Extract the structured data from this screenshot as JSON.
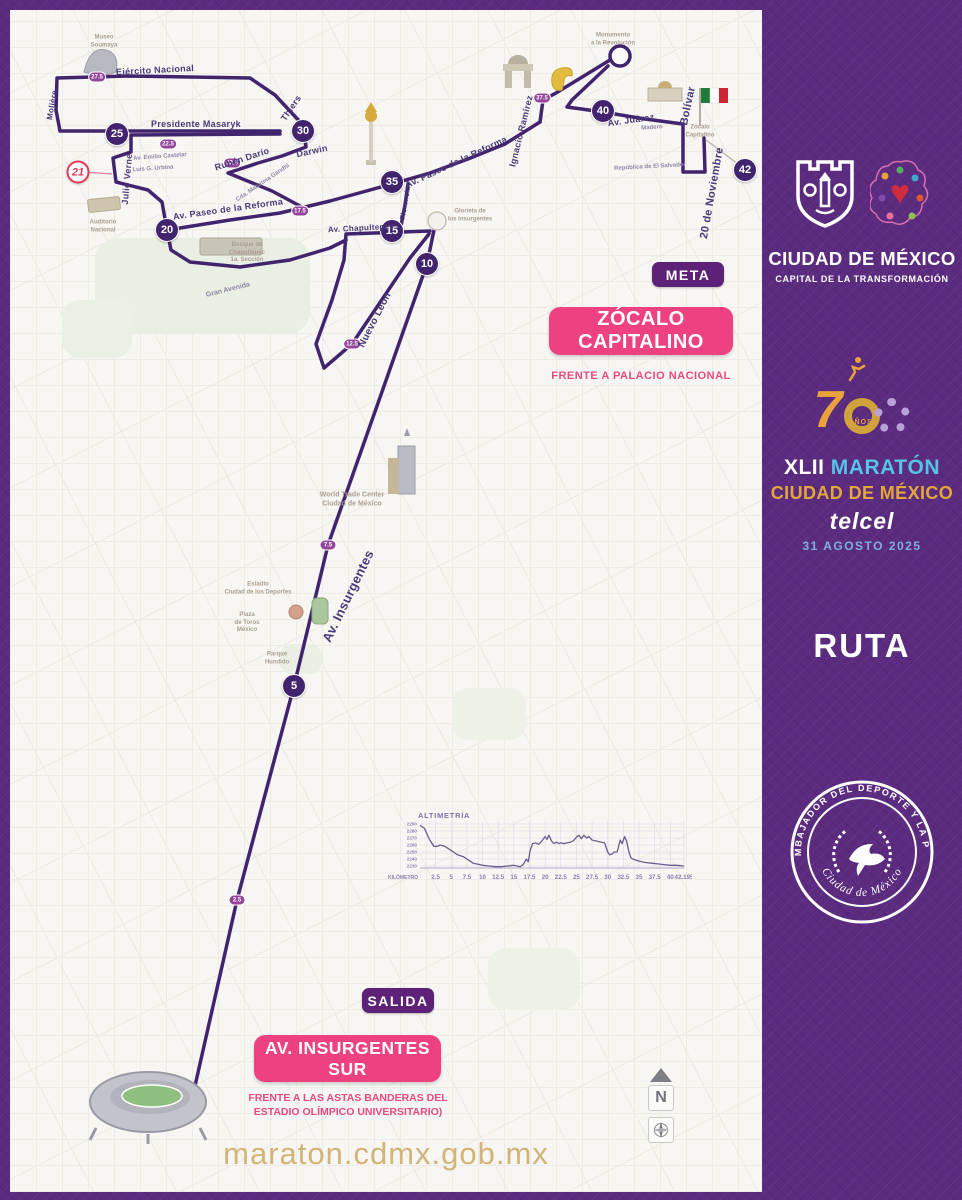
{
  "colors": {
    "purple_bg": "#5b2b7f",
    "route": "#41246d",
    "pink": "#ee4181",
    "gold_url": "#d2b478",
    "marker": "#41246d",
    "half_red": "#e63a56",
    "mini": "#94449a"
  },
  "sidebar": {
    "city_logo": {
      "title": "CIUDAD DE MÉXICO",
      "subtitle": "CAPITAL DE LA TRANSFORMACIÓN"
    },
    "anniversary": {
      "seven": "7",
      "years_label": "AÑOS"
    },
    "event": {
      "numeral": "XLII",
      "name": "MARATÓN",
      "city": "CIUDAD DE MÉXICO",
      "sponsor": "telcel",
      "date": "31 AGOSTO 2025"
    },
    "route_label": "RUTA",
    "badge": {
      "top_text": "EMBAJADOR DEL DEPORTE Y LA PAZ",
      "bottom_text": "Ciudad de México"
    }
  },
  "map": {
    "meta_label": "META",
    "finish_banner": "ZÓCALO CAPITALINO",
    "finish_sub": "FRENTE A PALACIO NACIONAL",
    "salida_label": "SALIDA",
    "start_banner": "AV. INSURGENTES SUR",
    "start_sub": "FRENTE A LAS ASTAS BANDERAS DEL\nESTADIO OLÍMPICO UNIVERSITARIO)",
    "url": "maraton.cdmx.gob.mx",
    "compass_letter": "N",
    "km_markers": [
      {
        "t": "5",
        "x": 294,
        "y": 686
      },
      {
        "t": "10",
        "x": 427,
        "y": 264
      },
      {
        "t": "15",
        "x": 392,
        "y": 231
      },
      {
        "t": "20",
        "x": 167,
        "y": 230
      },
      {
        "t": "25",
        "x": 117,
        "y": 134
      },
      {
        "t": "30",
        "x": 303,
        "y": 131
      },
      {
        "t": "35",
        "x": 392,
        "y": 182
      },
      {
        "t": "40",
        "x": 603,
        "y": 111
      },
      {
        "t": "42",
        "x": 745,
        "y": 170
      }
    ],
    "half_marker": {
      "t": "21",
      "x": 78,
      "y": 172
    },
    "minor_markers": [
      {
        "t": "2.5",
        "x": 237,
        "y": 900
      },
      {
        "t": "7.5",
        "x": 328,
        "y": 545
      },
      {
        "t": "12.5",
        "x": 352,
        "y": 344
      },
      {
        "t": "17.5",
        "x": 300,
        "y": 211
      },
      {
        "t": "22.5",
        "x": 168,
        "y": 144
      },
      {
        "t": "27.5",
        "x": 97,
        "y": 77
      },
      {
        "t": "32.5",
        "x": 232,
        "y": 163
      },
      {
        "t": "37.5",
        "x": 542,
        "y": 98
      }
    ],
    "streets": [
      {
        "t": "Ejército Nacional",
        "x": 155,
        "y": 70,
        "r": -3,
        "s": 9
      },
      {
        "t": "Molière",
        "x": 52,
        "y": 105,
        "r": -80,
        "s": 8
      },
      {
        "t": "Presidente Masaryk",
        "x": 196,
        "y": 124,
        "r": 0,
        "s": 9
      },
      {
        "t": "Thiers",
        "x": 291,
        "y": 108,
        "r": -56,
        "s": 9
      },
      {
        "t": "Darwin",
        "x": 312,
        "y": 151,
        "r": -12,
        "s": 9
      },
      {
        "t": "Rubén Darío",
        "x": 242,
        "y": 159,
        "r": -18,
        "s": 9
      },
      {
        "t": "Julio Verne",
        "x": 127,
        "y": 179,
        "r": -85,
        "s": 9
      },
      {
        "t": "Av. Paseo de la Reforma",
        "x": 228,
        "y": 209,
        "r": -8,
        "s": 9
      },
      {
        "t": "Av. Paseo de la Reforma",
        "x": 456,
        "y": 162,
        "r": -25,
        "s": 9
      },
      {
        "t": "Av. Chapultepec",
        "x": 361,
        "y": 228,
        "r": -3,
        "s": 8
      },
      {
        "t": "Florencia",
        "x": 406,
        "y": 203,
        "r": -80,
        "s": 7
      },
      {
        "t": "Nuevo León",
        "x": 375,
        "y": 320,
        "r": -63,
        "s": 10
      },
      {
        "t": "Av. Insurgentes",
        "x": 348,
        "y": 596,
        "r": -64,
        "s": 13
      },
      {
        "t": "Ignacio Ramírez",
        "x": 521,
        "y": 131,
        "r": -76,
        "s": 9
      },
      {
        "t": "Av. Juárez",
        "x": 631,
        "y": 120,
        "r": -8,
        "s": 9
      },
      {
        "t": "Bolívar",
        "x": 688,
        "y": 106,
        "r": -78,
        "s": 11
      },
      {
        "t": "20 de Noviembre",
        "x": 712,
        "y": 193,
        "r": -80,
        "s": 11
      }
    ],
    "streets_tiny": [
      {
        "t": "Av. Emilio Castelar",
        "x": 160,
        "y": 157,
        "r": -4,
        "s": 6
      },
      {
        "t": "Luis G. Urbina",
        "x": 153,
        "y": 169,
        "r": -4,
        "s": 6
      },
      {
        "t": "Cda. Mahatma Gandhi",
        "x": 263,
        "y": 183,
        "r": -34,
        "s": 6
      },
      {
        "t": "Gran Avenida",
        "x": 228,
        "y": 290,
        "r": -14,
        "s": 7
      },
      {
        "t": "Madero",
        "x": 652,
        "y": 128,
        "r": -4,
        "s": 6
      },
      {
        "t": "República de El Salvador",
        "x": 650,
        "y": 167,
        "r": -3,
        "s": 6
      }
    ],
    "pois": [
      {
        "t": "Museo\nSoumaya",
        "x": 104,
        "y": 42,
        "s": 6
      },
      {
        "t": "Auditorio\nNacional",
        "x": 103,
        "y": 227,
        "s": 6
      },
      {
        "t": "Bosque de\nChapultepec\n1a. Sección",
        "x": 247,
        "y": 253,
        "s": 6
      },
      {
        "t": "Glorieta de\nlos Insurgentes",
        "x": 470,
        "y": 216,
        "s": 6
      },
      {
        "t": "Monumento\na la Revolución",
        "x": 613,
        "y": 40,
        "s": 6
      },
      {
        "t": "Zócalo\nCapitalino",
        "x": 700,
        "y": 132,
        "s": 6
      },
      {
        "t": "World Trade Center\nCiudad de México",
        "x": 352,
        "y": 500,
        "s": 7
      },
      {
        "t": "Estadio\nCiudad de los Deportes",
        "x": 258,
        "y": 589,
        "s": 6
      },
      {
        "t": "Plaza\nde Toros\nMéxico",
        "x": 247,
        "y": 623,
        "s": 6
      },
      {
        "t": "Parque\nHundido",
        "x": 277,
        "y": 659,
        "s": 6
      }
    ],
    "route": {
      "lines": [
        [
          [
            190,
            1108
          ],
          [
            237,
            900
          ],
          [
            294,
            686
          ],
          [
            328,
            545
          ],
          [
            427,
            264
          ],
          [
            434,
            230
          ]
        ],
        [
          [
            429,
            234
          ],
          [
            410,
            258
          ],
          [
            352,
            344
          ],
          [
            324,
            368
          ],
          [
            316,
            344
          ],
          [
            332,
            300
          ],
          [
            344,
            260
          ],
          [
            346,
            234
          ],
          [
            430,
            231
          ]
        ],
        [
          [
            400,
            231
          ],
          [
            405,
            205
          ],
          [
            408,
            184
          ]
        ],
        [
          [
            167,
            230
          ],
          [
            180,
            228
          ],
          [
            230,
            220
          ],
          [
            280,
            213
          ],
          [
            330,
            201
          ],
          [
            370,
            190
          ],
          [
            392,
            184
          ],
          [
            430,
            173
          ],
          [
            468,
            159
          ],
          [
            505,
            144
          ],
          [
            540,
            122
          ]
        ],
        [
          [
            167,
            230
          ],
          [
            171,
            250
          ],
          [
            190,
            262
          ],
          [
            240,
            267
          ],
          [
            290,
            260
          ],
          [
            330,
            248
          ],
          [
            346,
            240
          ]
        ],
        [
          [
            167,
            230
          ],
          [
            162,
            202
          ],
          [
            148,
            190
          ],
          [
            116,
            182
          ],
          [
            113,
            158
          ],
          [
            131,
            152
          ],
          [
            131,
            135
          ],
          [
            280,
            134
          ]
        ],
        [
          [
            280,
            131
          ],
          [
            95,
            131
          ],
          [
            60,
            131
          ],
          [
            56,
            110
          ],
          [
            57,
            78
          ],
          [
            130,
            76
          ],
          [
            250,
            78
          ],
          [
            275,
            95
          ],
          [
            303,
            125
          ],
          [
            306,
            147
          ],
          [
            282,
            156
          ],
          [
            258,
            163
          ],
          [
            228,
            173
          ],
          [
            250,
            182
          ],
          [
            272,
            191
          ],
          [
            300,
            206
          ]
        ],
        [
          [
            540,
            122
          ],
          [
            543,
            100
          ],
          [
            556,
            93
          ],
          [
            610,
            60
          ]
        ],
        [
          [
            608,
            66
          ],
          [
            572,
            100
          ],
          [
            567,
            107
          ],
          [
            603,
            112
          ],
          [
            645,
            119
          ],
          [
            683,
            124
          ],
          [
            683,
            172
          ],
          [
            705,
            172
          ],
          [
            704,
            138
          ]
        ]
      ],
      "thin_lines": [
        {
          "pts": [
            [
              82,
              172
            ],
            [
              112,
              174
            ]
          ],
          "color": "#ef7c9a",
          "w": 1.2
        },
        {
          "pts": [
            [
              706,
              140
            ],
            [
              738,
              164
            ]
          ],
          "color": "#b9b2a6",
          "w": 1.2
        }
      ],
      "circles": [
        {
          "x": 437,
          "y": 221,
          "r": 9,
          "fill": "#f3f1ec",
          "stroke": "#c6c0b4",
          "w": 1.5
        },
        {
          "x": 620,
          "y": 56,
          "r": 10,
          "fill": "#ffffff",
          "stroke": "#41246d",
          "w": 3.5
        }
      ],
      "start_bar": {
        "x": 174,
        "y": 1102,
        "w": 30,
        "h": 8
      }
    }
  },
  "chart_data": {
    "type": "line",
    "title": "ALTIMETRÍA",
    "xlabel": "KILÓMETRO",
    "ylabel": "",
    "xlim": [
      0,
      42.195
    ],
    "ylim": [
      2220,
      2295
    ],
    "xticks": [
      2.5,
      5,
      7.5,
      10,
      12.5,
      15,
      17.5,
      20,
      22.5,
      25,
      27.5,
      30,
      32.5,
      35,
      37.5,
      40,
      42.195
    ],
    "yticks": [
      2290,
      2280,
      2270,
      2260,
      2250,
      2240,
      2230
    ],
    "grid": true,
    "series": [
      {
        "name": "Elevación (m)",
        "points": [
          [
            0,
            2288
          ],
          [
            0.7,
            2284
          ],
          [
            1.5,
            2268
          ],
          [
            2.2,
            2258
          ],
          [
            2.8,
            2258
          ],
          [
            3.2,
            2260
          ],
          [
            4,
            2258
          ],
          [
            5,
            2252
          ],
          [
            6,
            2246
          ],
          [
            7,
            2243
          ],
          [
            7.5,
            2240
          ],
          [
            8,
            2237
          ],
          [
            8.5,
            2234
          ],
          [
            9,
            2233
          ],
          [
            10,
            2231
          ],
          [
            11,
            2230
          ],
          [
            12,
            2229
          ],
          [
            13,
            2229
          ],
          [
            14,
            2230
          ],
          [
            15,
            2231
          ],
          [
            16,
            2229
          ],
          [
            16.5,
            2232
          ],
          [
            17,
            2240
          ],
          [
            17.3,
            2236
          ],
          [
            17.6,
            2252
          ],
          [
            18,
            2262
          ],
          [
            18.5,
            2263
          ],
          [
            19,
            2261
          ],
          [
            19.5,
            2266
          ],
          [
            20,
            2272
          ],
          [
            20.3,
            2268
          ],
          [
            20.6,
            2274
          ],
          [
            21,
            2266
          ],
          [
            21.4,
            2262
          ],
          [
            21.8,
            2264
          ],
          [
            22.2,
            2262
          ],
          [
            22.6,
            2263
          ],
          [
            23,
            2262
          ],
          [
            23.5,
            2263
          ],
          [
            24,
            2264
          ],
          [
            24.5,
            2266
          ],
          [
            25,
            2271
          ],
          [
            25.4,
            2274
          ],
          [
            25.8,
            2269
          ],
          [
            26.2,
            2274
          ],
          [
            26.6,
            2270
          ],
          [
            27,
            2272
          ],
          [
            27.5,
            2267
          ],
          [
            28,
            2266
          ],
          [
            28.5,
            2265
          ],
          [
            29,
            2264
          ],
          [
            29.5,
            2263
          ],
          [
            30,
            2250
          ],
          [
            30.3,
            2246
          ],
          [
            30.7,
            2247
          ],
          [
            31,
            2250
          ],
          [
            31.5,
            2250
          ],
          [
            32,
            2267
          ],
          [
            32.3,
            2262
          ],
          [
            32.7,
            2272
          ],
          [
            33,
            2266
          ],
          [
            33.4,
            2250
          ],
          [
            33.7,
            2242
          ],
          [
            34,
            2240
          ],
          [
            35,
            2237
          ],
          [
            36,
            2235
          ],
          [
            37,
            2234
          ],
          [
            38,
            2233
          ],
          [
            39,
            2232
          ],
          [
            40,
            2231
          ],
          [
            41,
            2231
          ],
          [
            42.195,
            2230
          ]
        ]
      }
    ]
  }
}
